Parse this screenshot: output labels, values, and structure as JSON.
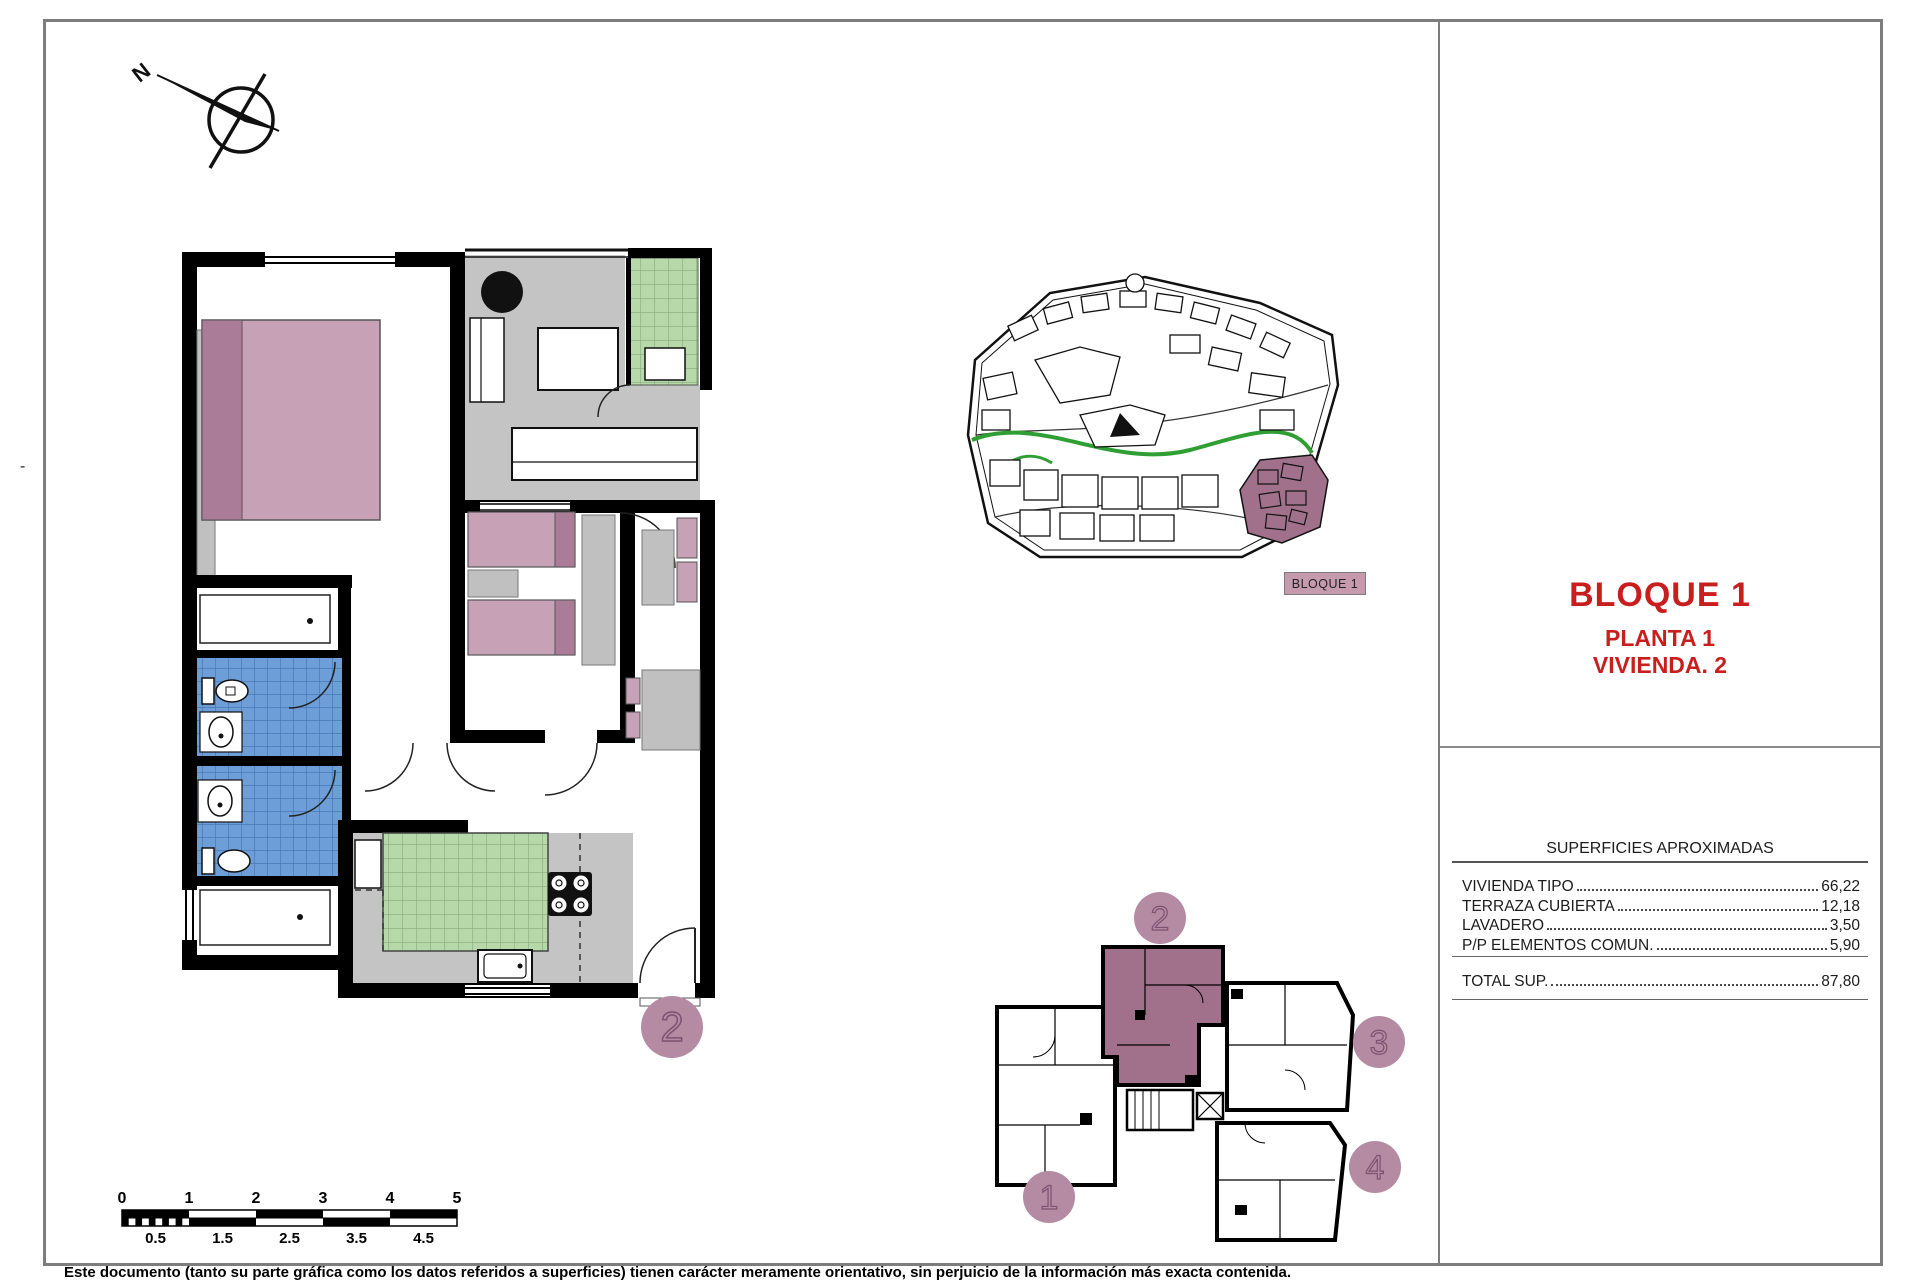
{
  "compass": {
    "label": "N"
  },
  "main_plan": {
    "unit_badge": "2"
  },
  "site_plan": {
    "label": "BLOQUE 1"
  },
  "key_plan": {
    "badges": [
      "1",
      "2",
      "3",
      "4"
    ]
  },
  "title_block": {
    "title": "BLOQUE 1",
    "line1": "PLANTA 1",
    "line2": "VIVIENDA. 2"
  },
  "surfaces": {
    "header": "SUPERFICIES APROXIMADAS",
    "rows": [
      {
        "label": "VIVIENDA TIPO",
        "value": "66,22"
      },
      {
        "label": "TERRAZA CUBIERTA",
        "value": "12,18"
      },
      {
        "label": "LAVADERO",
        "value": "3,50"
      },
      {
        "label": "P/P ELEMENTOS COMUN.",
        "value": "5,90"
      }
    ],
    "total": {
      "label": "TOTAL SUP.",
      "value": "87,80"
    }
  },
  "scale_bar": {
    "top": [
      "0",
      "1",
      "2",
      "3",
      "4",
      "5"
    ],
    "bottom": [
      "0.5",
      "1.5",
      "2.5",
      "3.5",
      "4.5"
    ]
  },
  "footer": {
    "disclaimer": "Este documento (tanto su parte gráfica como los datos referidos a superficies) tienen carácter meramente orientativo, sin perjuicio de la información más exacta contenida."
  },
  "margin": {
    "dash": "-"
  },
  "colors": {
    "accent_red": "#c81e1e",
    "highlight_mauve": "#a1718c",
    "badge_pink": "#b58ba4",
    "bed_pink": "#c7a1b6",
    "bed_pink_dark": "#aa7c97",
    "terrace_gray": "#c4c4c4",
    "tile_blue": "#6d9ed8",
    "tile_green": "#b7d9aa",
    "site_green": "#2f9e33"
  }
}
